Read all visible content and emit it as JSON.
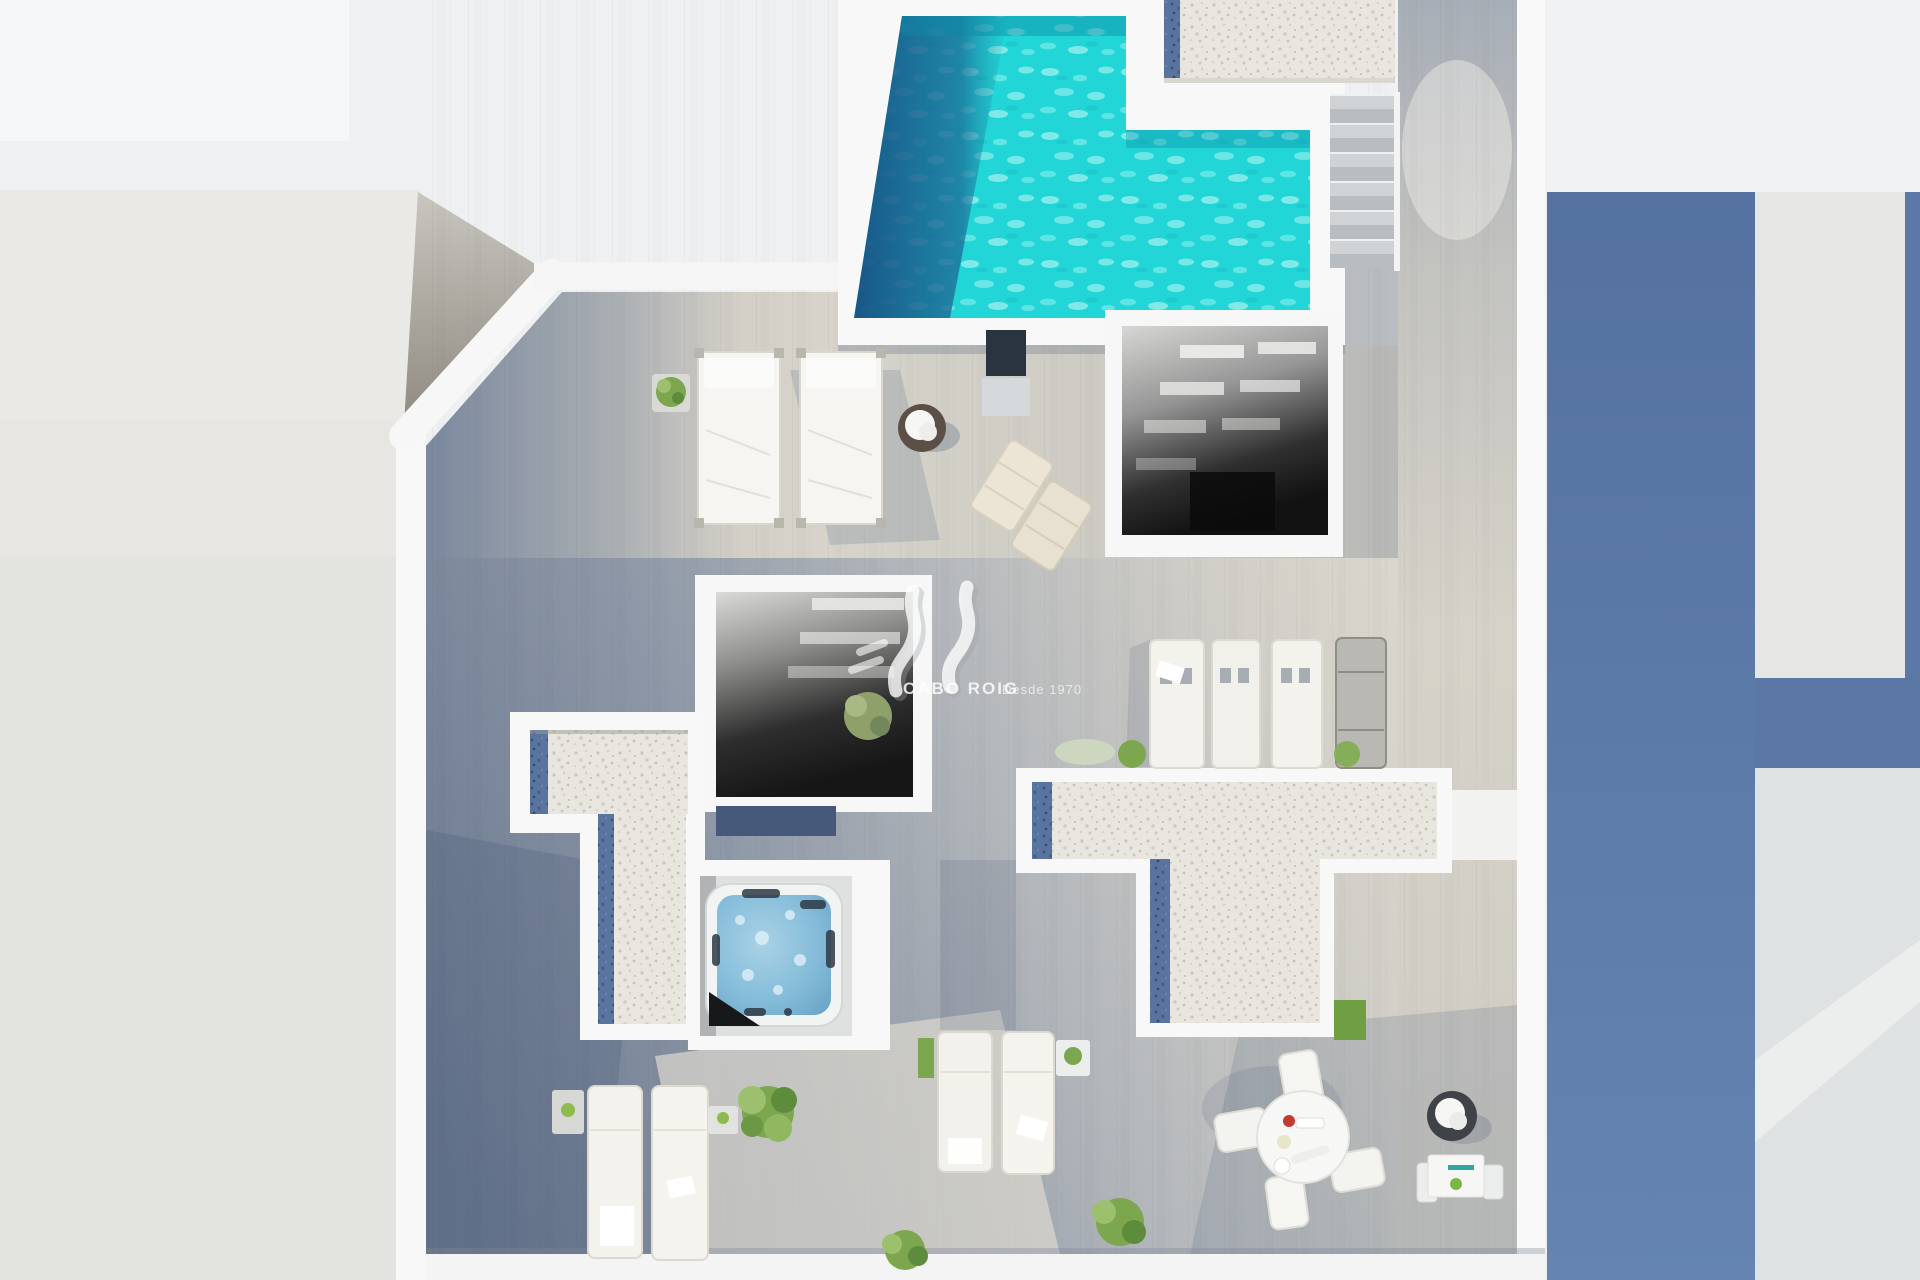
{
  "watermark": {
    "brand": "CABO ROIG",
    "tagline": "Desde 1970"
  },
  "palette": {
    "background": "#eef0f2",
    "wall_white": "#f7f8f7",
    "pool_water": "#22d5d6",
    "pool_shadow": "#1d5c8e",
    "deck_shadow": "#6b7990",
    "deck_sunlit": "#ddd9d0",
    "gravel": "#e8e6df",
    "skylight_blue": "#5a74a0",
    "neighbor_shadow_blue": "#5b77a5",
    "jacuzzi_water": "#85bcd9",
    "grass": "#6f9e43",
    "plant_green": "#7ca74f",
    "wicker_brown": "#574c42"
  },
  "scene": {
    "type": "aerial 3D render of a rooftop terrace / solarium floor plan",
    "objects": [
      "swimming-pool",
      "pool-shadow",
      "gravel-roof-strip",
      "roof-access-stairs",
      "stairwell-opening-upper",
      "stairwell-opening-lower",
      "skylight-strips",
      "gravel-roof-left-T",
      "gravel-roof-center-T",
      "jacuzzi",
      "double-daybeds",
      "wicker-chair",
      "sun-mats",
      "lounger-row",
      "bottom-left-loungers",
      "bottom-center-loungers",
      "round-dining-set",
      "bistro-table-set",
      "planters-and-bushes",
      "grass-patch",
      "neighbor-roofs",
      "shadowed-wood-deck"
    ]
  }
}
